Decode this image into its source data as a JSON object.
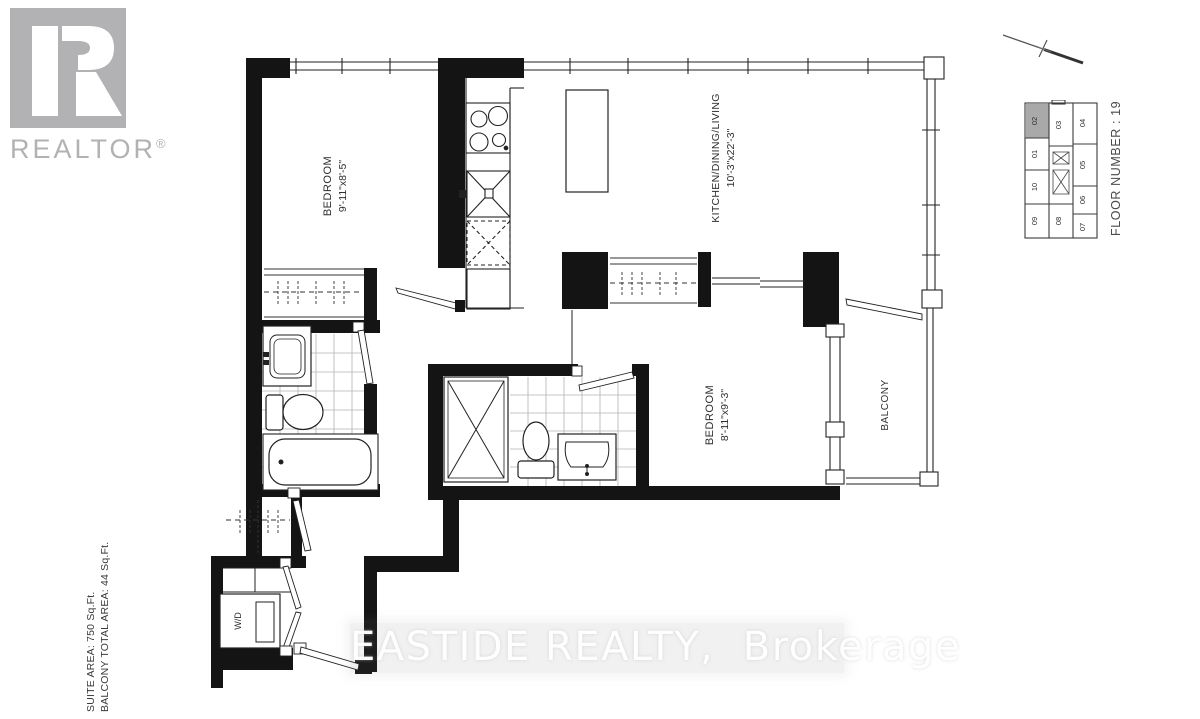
{
  "branding": {
    "logo_text": "REALTOR",
    "registered_mark": "®"
  },
  "watermark": "EASTIDE REALTY,  Brokerage",
  "area_info": {
    "suite": "SUITE AREA: 750 Sq.Ft.",
    "balcony_total": "BALCONY TOTAL AREA: 44 Sq.Ft."
  },
  "rooms": {
    "bedroom1": {
      "name": "BEDROOM",
      "dims": "9'-11\"x8'-5\""
    },
    "kitchen_dining_living": {
      "name": "KITCHEN/DINING/LIVING",
      "dims": "10'-3\"x22'-3\""
    },
    "bedroom2": {
      "name": "BEDROOM",
      "dims": "8'-11\"x9'-3\""
    },
    "balcony": {
      "name": "BALCONY"
    },
    "laundry": {
      "name": "W/D"
    }
  },
  "key_plan": {
    "floor_label": "FLOOR NUMBER : 19",
    "highlighted_unit": "02",
    "units": [
      "02",
      "01",
      "10",
      "09",
      "03",
      "08",
      "04",
      "05",
      "06",
      "07"
    ]
  }
}
